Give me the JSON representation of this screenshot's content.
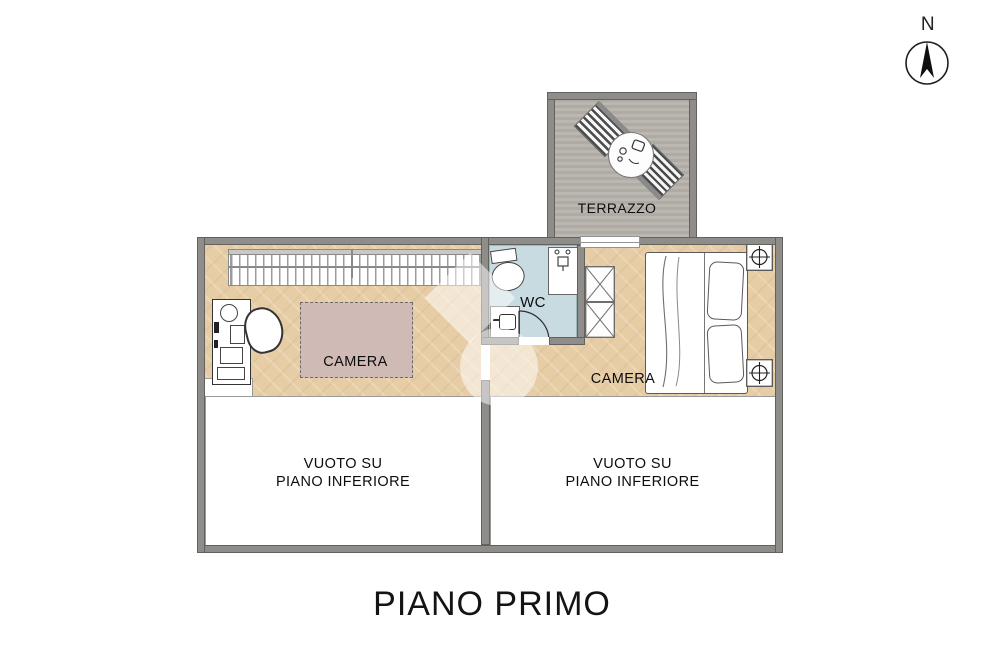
{
  "meta": {
    "floor_title": "PIANO PRIMO"
  },
  "compass": {
    "label": "N"
  },
  "rooms": {
    "terrace": {
      "label": "TERRAZZO"
    },
    "bedroom_left": {
      "label": "CAMERA"
    },
    "bedroom_right": {
      "label": "CAMERA"
    },
    "wc": {
      "label": "WC"
    },
    "void_left": {
      "lines": [
        "VUOTO SU",
        "PIANO INFERIORE"
      ]
    },
    "void_right": {
      "lines": [
        "VUOTO SU",
        "PIANO INFERIORE"
      ]
    }
  },
  "colors": {
    "wall": "#8f8d8a",
    "wall_edge": "#63615e",
    "wood_floor": "#e7cda6",
    "terrace_floor": "#b6b2ab",
    "wc_floor": "#c8dbe1",
    "bed_accent": "#cfbab6",
    "text": "#111111",
    "background": "#ffffff"
  }
}
